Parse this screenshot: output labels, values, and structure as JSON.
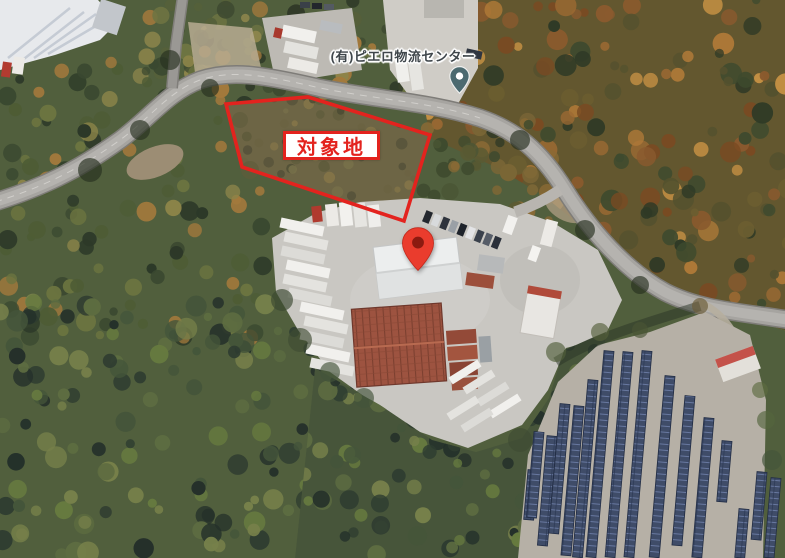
{
  "map": {
    "view": "satellite",
    "site_overlay": {
      "label": "対象地",
      "outline_color": "#e3231e"
    },
    "poi": {
      "name": "(有)ピエロ物流センター",
      "pin_color": "#4c6a70"
    },
    "destination_marker": {
      "pin_color": "#ea3c2d",
      "pin_dot_color": "#8c1a10"
    }
  }
}
